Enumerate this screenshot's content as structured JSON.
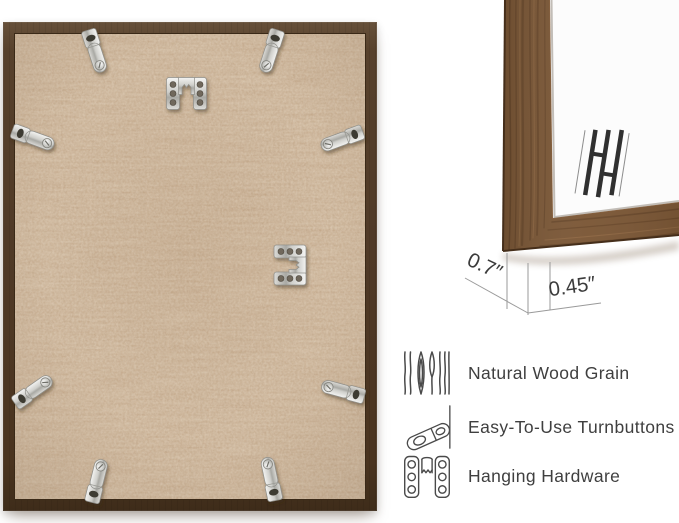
{
  "view": {
    "description": "Back view of picture frame with corner close-up and feature list",
    "background": "#ffffff"
  },
  "dimensions": {
    "depth": "0.7″",
    "face_width": "0.45″"
  },
  "features": [
    {
      "icon": "wood-grain-icon",
      "label": "Natural Wood Grain"
    },
    {
      "icon": "turnbutton-icon",
      "label": "Easy-To-Use Turnbuttons"
    },
    {
      "icon": "hanging-hardware-icon",
      "label": "Hanging Hardware"
    }
  ],
  "hardware": {
    "turnbutton_count": 8,
    "sawtooth_hanger_count": 2
  },
  "colors": {
    "frame_wood": "#7b5736",
    "frame_back_border": "#503a27",
    "mdf_backing": "#c8a887",
    "metal_hardware": "#cfcfcb",
    "art_bars": "#303030",
    "label_text": "#3f3f3f",
    "dimension_lines": "#9a9a9a",
    "background": "#ffffff"
  }
}
